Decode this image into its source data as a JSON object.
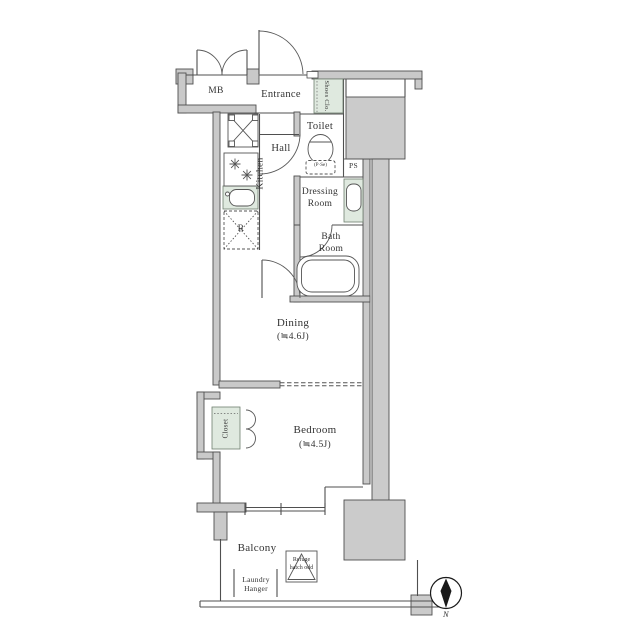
{
  "title": "apartment-floor-plan",
  "labels": {
    "mb": "MB",
    "entrance": "Entrance",
    "shoes_closet": "Shoes Clo.",
    "toilet": "Toilet",
    "toilet_note": "(P·Se)",
    "ps": "PS",
    "hall": "Hall",
    "kitchen": "Kitchen",
    "refrigerator": "R",
    "dressing_room": "Dressing Room",
    "bath_room": "Bath Room",
    "dining": "Dining",
    "dining_size": "(≒4.6J)",
    "closet": "Closet",
    "bedroom": "Bedroom",
    "bedroom_size": "(≒4.5J)",
    "balcony": "Balcony",
    "laundry_hanger": "Laundry Hanger",
    "refuge_hatch": "Refuge hatch odd",
    "compass_north": "N"
  },
  "colors": {
    "wall_fill": "#c9c9c9",
    "block_gray": "#cbcbcb",
    "line": "#4f4f4f",
    "fixture_green": "#dfe9df",
    "text": "#333333"
  }
}
